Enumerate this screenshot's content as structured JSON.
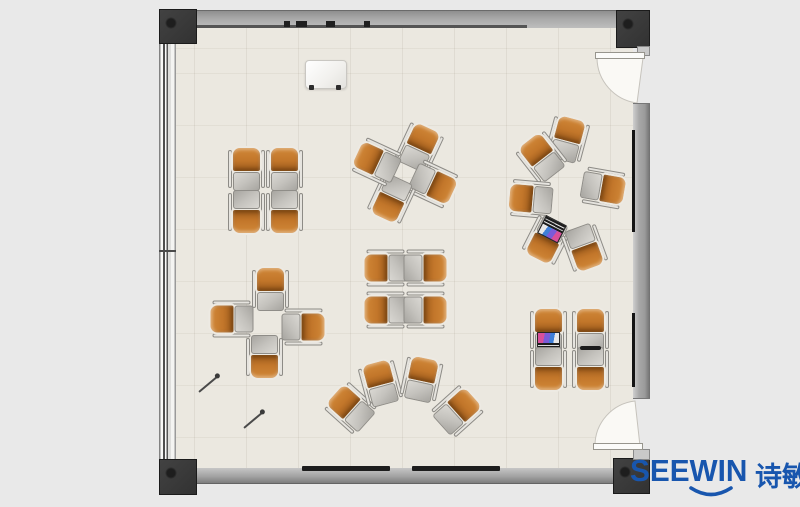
{
  "logo": {
    "brand": "SEEWIN",
    "cjk": "诗敏",
    "color": "#1856ae"
  },
  "colors": {
    "background": "#e9e9e9",
    "floor": "#ebe8e0",
    "wall": "#a7a7a7",
    "column": "#383838",
    "chair_seat_orange": "#c2762a",
    "desk_gray": "#c4c2bd",
    "logo_blue": "#1856ae"
  },
  "furniture": {
    "unit_size": {
      "w": 37,
      "h": 46
    },
    "clusters": [
      {
        "id": "cluster-top-left",
        "units": [
          {
            "x": 246,
            "y": 169,
            "rot": 0
          },
          {
            "x": 284,
            "y": 169,
            "rot": 0
          },
          {
            "x": 246,
            "y": 212,
            "rot": 180
          },
          {
            "x": 284,
            "y": 212,
            "rot": 180
          }
        ]
      },
      {
        "id": "cluster-top-middle",
        "units": [
          {
            "x": 419,
            "y": 147,
            "rot": 25
          },
          {
            "x": 433,
            "y": 184,
            "rot": 115
          },
          {
            "x": 391,
            "y": 199,
            "rot": 205
          },
          {
            "x": 376,
            "y": 162,
            "rot": 295
          }
        ]
      },
      {
        "id": "cluster-right-circle",
        "units": [
          {
            "x": 567,
            "y": 139,
            "rot": 15
          },
          {
            "x": 541,
            "y": 157,
            "rot": -38
          },
          {
            "x": 530,
            "y": 199,
            "rot": -85
          },
          {
            "x": 603,
            "y": 188,
            "rot": 100
          },
          {
            "x": 546,
            "y": 240,
            "rot": 207,
            "acc": "laptop"
          },
          {
            "x": 584,
            "y": 248,
            "rot": 160
          }
        ]
      },
      {
        "id": "cluster-mid-left-pinwheel",
        "units": [
          {
            "x": 270,
            "y": 289,
            "rot": 0
          },
          {
            "x": 231,
            "y": 319,
            "rot": -90
          },
          {
            "x": 303,
            "y": 327,
            "rot": 90
          },
          {
            "x": 264,
            "y": 357,
            "rot": 180
          }
        ]
      },
      {
        "id": "cluster-middle",
        "units": [
          {
            "x": 385,
            "y": 268,
            "rot": -90
          },
          {
            "x": 425,
            "y": 268,
            "rot": 90
          },
          {
            "x": 385,
            "y": 310,
            "rot": -90
          },
          {
            "x": 425,
            "y": 310,
            "rot": 90
          }
        ]
      },
      {
        "id": "cluster-bottom-arc",
        "units": [
          {
            "x": 350,
            "y": 408,
            "rot": -48
          },
          {
            "x": 380,
            "y": 383,
            "rot": -15
          },
          {
            "x": 421,
            "y": 379,
            "rot": 12
          },
          {
            "x": 457,
            "y": 411,
            "rot": 48
          }
        ]
      },
      {
        "id": "cluster-bottom-right",
        "units": [
          {
            "x": 548,
            "y": 330,
            "rot": 0,
            "acc": "laptop"
          },
          {
            "x": 590,
            "y": 330,
            "rot": 0
          },
          {
            "x": 548,
            "y": 369,
            "rot": 180
          },
          {
            "x": 590,
            "y": 369,
            "rot": 180,
            "acc": "blackbar"
          }
        ]
      }
    ],
    "props": {
      "pens": [
        {
          "x": 196,
          "y": 383,
          "rot": -40
        },
        {
          "x": 241,
          "y": 419,
          "rot": -40
        }
      ]
    }
  }
}
